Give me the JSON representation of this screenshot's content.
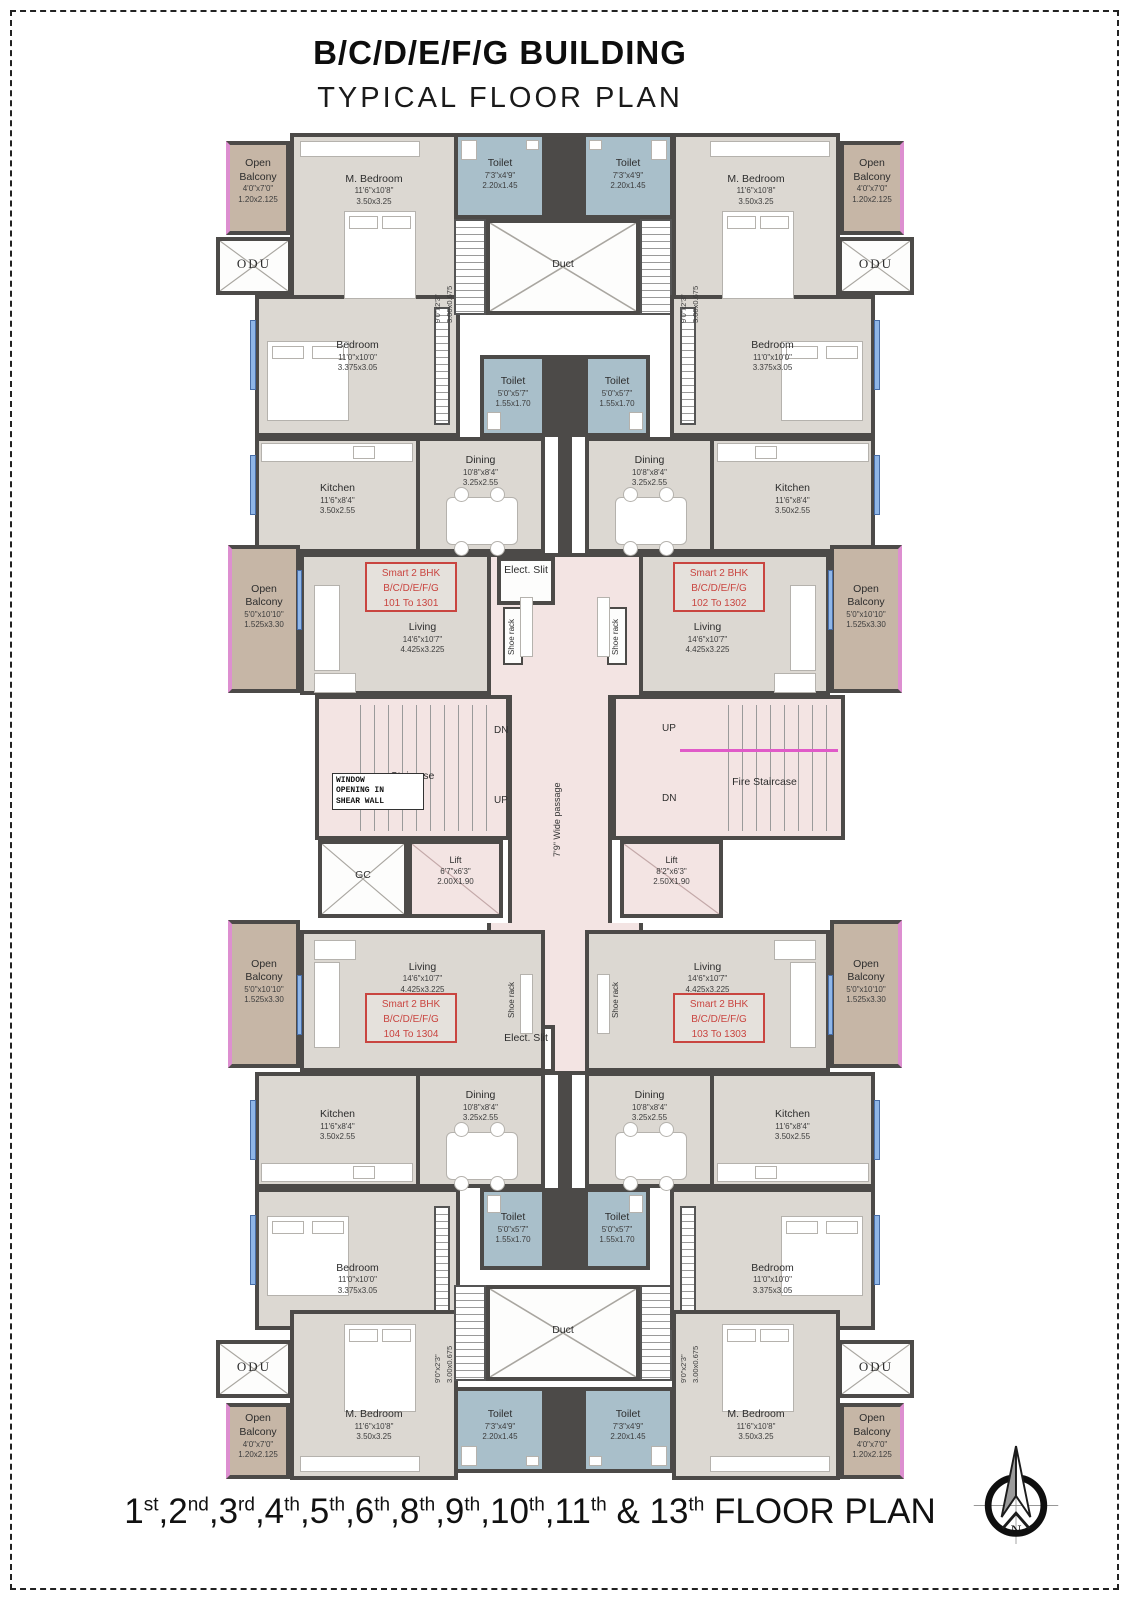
{
  "header": {
    "title": "B/C/D/E/F/G BUILDING",
    "subtitle": "TYPICAL FLOOR PLAN"
  },
  "footer": {
    "floors": [
      {
        "n": "1",
        "s": "st"
      },
      {
        "n": "2",
        "s": "nd"
      },
      {
        "n": "3",
        "s": "rd"
      },
      {
        "n": "4",
        "s": "th"
      },
      {
        "n": "5",
        "s": "th"
      },
      {
        "n": "6",
        "s": "th"
      },
      {
        "n": "8",
        "s": "th"
      },
      {
        "n": "9",
        "s": "th"
      },
      {
        "n": "10",
        "s": "th"
      },
      {
        "n": "11",
        "s": "th"
      }
    ],
    "sep": ",",
    "conj": "&",
    "last": {
      "n": "13",
      "s": "th"
    },
    "tail": "FLOOR PLAN"
  },
  "compass": {
    "label": "N"
  },
  "colors": {
    "wall": "#4c4a48",
    "floor": "#dcd8d2",
    "toilet_blue": "#a9bfca",
    "balcony_tan": "#c6b6a6",
    "passage_pink": "#f3e4e3",
    "accent_red": "#c94540",
    "magenta_line": "#e05ac8",
    "window_blue": "#8fb6e8"
  },
  "units": {
    "u101": {
      "type": "Smart 2 BHK",
      "building": "B/C/D/E/F/G",
      "range": "101 To 1301"
    },
    "u102": {
      "type": "Smart 2 BHK",
      "building": "B/C/D/E/F/G",
      "range": "102 To 1302"
    },
    "u103": {
      "type": "Smart 2 BHK",
      "building": "B/C/D/E/F/G",
      "range": "103 To 1303"
    },
    "u104": {
      "type": "Smart 2 BHK",
      "building": "B/C/D/E/F/G",
      "range": "104 To 1304"
    }
  },
  "rooms": {
    "m_bedroom": {
      "name": "M. Bedroom",
      "ft": "11'6\"x10'8\"",
      "m": "3.50x3.25"
    },
    "bedroom": {
      "name": "Bedroom",
      "ft": "11'0\"x10'0\"",
      "m": "3.375x3.05"
    },
    "kitchen": {
      "name": "Kitchen",
      "ft": "11'6\"x8'4\"",
      "m": "3.50x2.55"
    },
    "dining": {
      "name": "Dining",
      "ft": "10'8\"x8'4\"",
      "m": "3.25x2.55"
    },
    "living": {
      "name": "Living",
      "ft": "14'6\"x10'7\"",
      "m": "4.425x3.225"
    },
    "toilet_big": {
      "name": "Toilet",
      "ft": "7'3\"x4'9\"",
      "m": "2.20x1.45"
    },
    "toilet_small": {
      "name": "Toilet",
      "ft": "5'0\"x5'7\"",
      "m": "1.55x1.70"
    },
    "balcony_small": {
      "name": "Open Balcony",
      "ft": "4'0\"x7'0\"",
      "m": "1.20x2.125"
    },
    "balcony_large": {
      "name": "Open Balcony",
      "ft": "5'0\"x10'10\"",
      "m": "1.525x3.30"
    },
    "wardrobe_niche": {
      "ft": "9'0\"x2'3\"",
      "m": "3.00x0.675"
    },
    "duct": {
      "name": "Duct"
    },
    "odu": {
      "name": "ODU"
    },
    "gc": {
      "name": "GC"
    },
    "lift_left": {
      "name": "Lift",
      "ft": "6'7\"x6'3\"",
      "m": "2.00X1.90"
    },
    "lift_right": {
      "name": "Lift",
      "ft": "8'2\"x6'3\"",
      "m": "2.50X1.90"
    },
    "staircase": {
      "name": "Staircase"
    },
    "fire_staircase": {
      "name": "Fire Staircase"
    },
    "passage": {
      "name": "7'9\" Wide passage"
    },
    "elect_slit": {
      "name": "Elect. Slit"
    },
    "shoe_rack": {
      "name": "Shoe rack"
    },
    "window_note": {
      "line1": "WINDOW",
      "line2": "OPENING IN",
      "line3": "SHEAR WALL"
    },
    "dn": "DN",
    "up": "UP"
  }
}
